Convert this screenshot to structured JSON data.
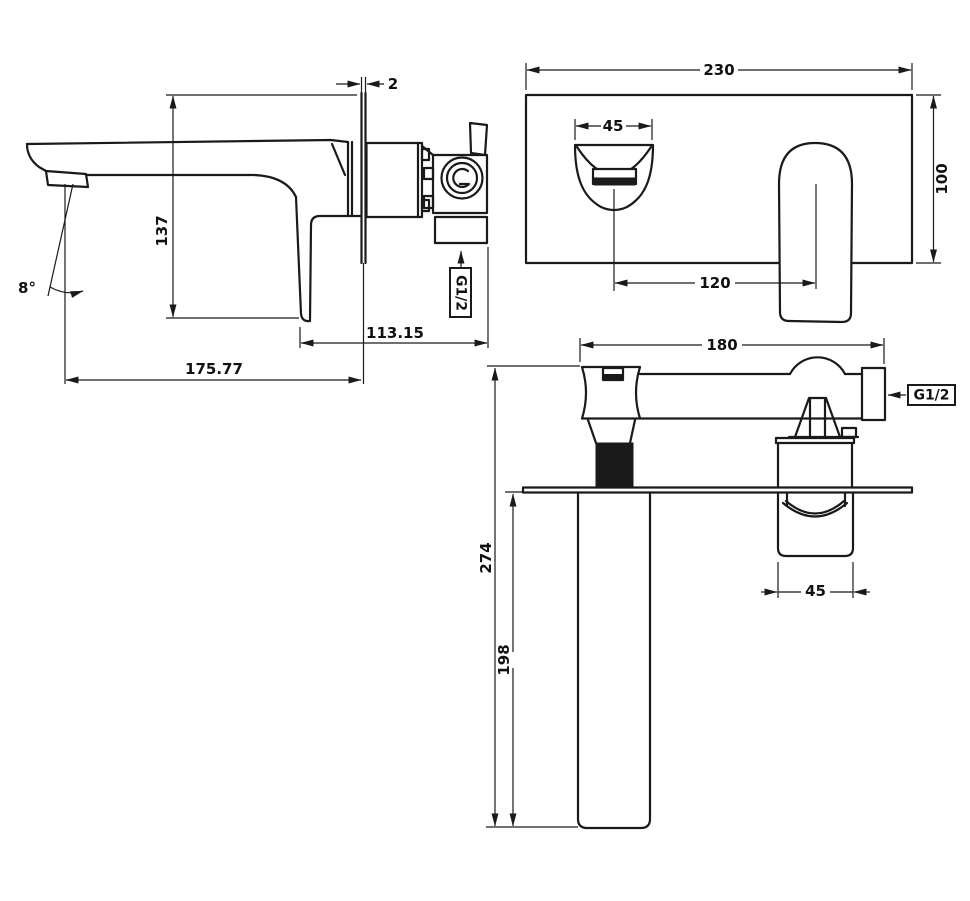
{
  "drawing": {
    "type": "technical-dimension-drawing",
    "colors": {
      "line": "#1a1a1a",
      "background": "#ffffff"
    },
    "side_view": {
      "wall_thickness": "2",
      "height": "137",
      "spout_angle": "8°",
      "depth_behind_wall": "113.15",
      "spout_reach": "175.77",
      "inlet_thread": "G1/2"
    },
    "front_view": {
      "plate_width": "230",
      "outlet_width": "45",
      "plate_height": "100",
      "centre_distance": "120"
    },
    "top_view": {
      "body_width": "180",
      "inlet_thread": "G1/2",
      "overall_depth": "274",
      "spout_projection": "198",
      "handle_width": "45"
    }
  }
}
